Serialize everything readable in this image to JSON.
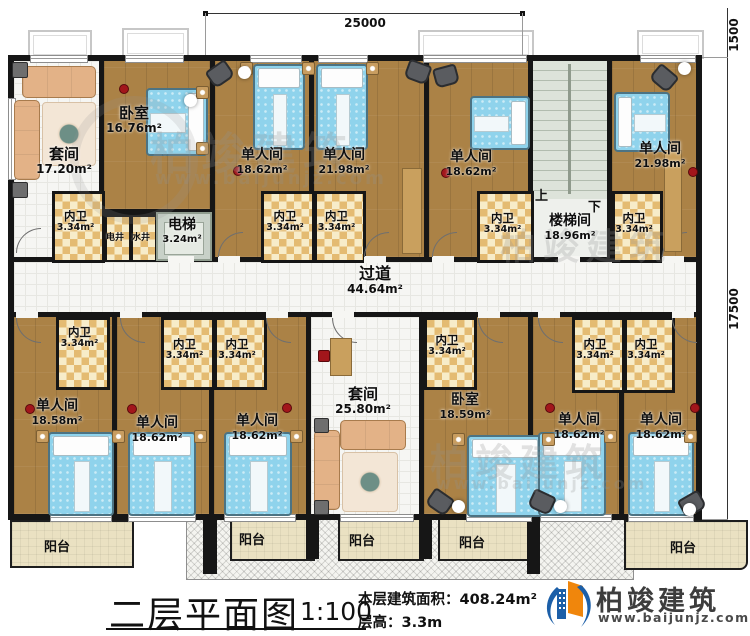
{
  "rooms": {
    "suite1": {
      "name": "套间",
      "area": "17.20m²"
    },
    "bedroom1": {
      "name": "卧室",
      "area": "16.76m²"
    },
    "single_a": {
      "name": "单人间",
      "area": "18.62m²"
    },
    "single_b": {
      "name": "单人间",
      "area": "21.98m²"
    },
    "single_c": {
      "name": "单人间",
      "area": "18.62m²"
    },
    "single_d": {
      "name": "单人间",
      "area": "21.98m²"
    },
    "single_e": {
      "name": "单人间",
      "area": "18.58m²"
    },
    "single_f": {
      "name": "单人间",
      "area": "18.62m²"
    },
    "single_g": {
      "name": "单人间",
      "area": "18.62m²"
    },
    "suite2": {
      "name": "套间",
      "area": "25.80m²"
    },
    "bedroom2": {
      "name": "卧室",
      "area": "18.59m²"
    },
    "single_h": {
      "name": "单人间",
      "area": "18.62m²"
    },
    "single_i": {
      "name": "单人间",
      "area": "18.62m²"
    }
  },
  "bathroom": {
    "name": "内卫",
    "area": "3.34m²"
  },
  "corridor": {
    "name": "过道",
    "area": "44.64m²"
  },
  "stairwell": {
    "name": "楼梯间",
    "area": "18.96m²",
    "up": "上",
    "down": "下"
  },
  "elevator": {
    "name": "电梯",
    "area": "3.24m²"
  },
  "shafts": {
    "electric": "电井",
    "water": "水井"
  },
  "balcony": "阳台",
  "dimensions": {
    "top": "25000",
    "right_upper": "1500",
    "right_lower": "17500"
  },
  "title_block": {
    "title": "二层平面图",
    "scale": "1:100",
    "area_label": "本层建筑面积：",
    "area_value": "408.24m²",
    "height_label": "层高：",
    "height_value": "3.3m"
  },
  "logo": {
    "company": "柏竣建筑",
    "website": "www.baijunjz.com"
  },
  "watermark": {
    "text": "柏竣建筑",
    "url": "www.baijunjz.com"
  },
  "colors": {
    "wall": "#161616",
    "wood": "#ab8246",
    "bath_checker": "#e4bb72",
    "bed": "#8fd3ec",
    "brand_blue": "#1c5fa8",
    "brand_orange": "#f0860c"
  }
}
